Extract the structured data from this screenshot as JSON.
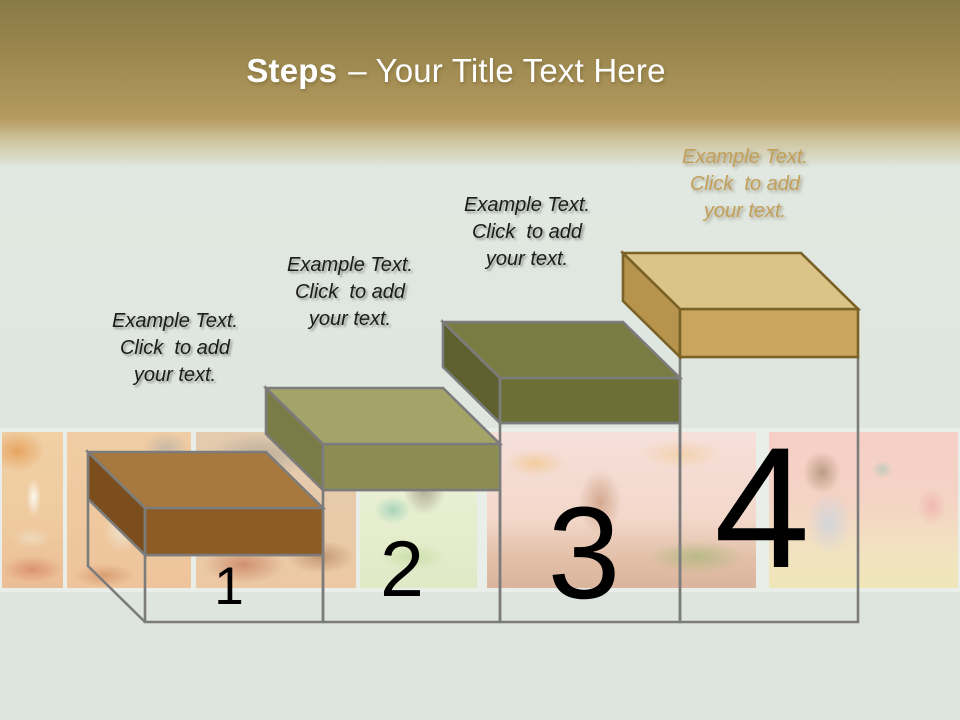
{
  "title": {
    "bold": "Steps",
    "rest": "– Your Title Text Here"
  },
  "steps": [
    {
      "number": "1",
      "label_lines": [
        "Example Text.",
        "Click  to add",
        "your text."
      ],
      "colors": {
        "top": "#A8793F",
        "front": "#8D5B24",
        "side": "#7C4E1D",
        "outline": "#7C7C7C"
      }
    },
    {
      "number": "2",
      "label_lines": [
        "Example Text.",
        "Click  to add",
        "your text."
      ],
      "colors": {
        "top": "#A4A469",
        "front": "#8D8D53",
        "side": "#7B7B47",
        "outline": "#7C7C7C"
      }
    },
    {
      "number": "3",
      "label_lines": [
        "Example Text.",
        "Click  to add",
        "your text."
      ],
      "colors": {
        "top": "#7A7C43",
        "front": "#6D7036",
        "side": "#5E602D",
        "outline": "#7C7C7C"
      }
    },
    {
      "number": "4",
      "label_lines": [
        "Example Text.",
        "Click  to add",
        "your text."
      ],
      "label_color": "#C2A05A",
      "colors": {
        "top": "#DCC489",
        "front": "#C9A55E",
        "side": "#B7944D",
        "outline": "#7A6226"
      }
    }
  ],
  "theme": {
    "header_gold_top": "#8A7A46",
    "header_gold": "#B49A5E",
    "body_background": "#DFE6DF",
    "wireframe": "#7C7C7C",
    "number_color": "#000000",
    "label_color": "#1C1C1C",
    "title_color": "#FFFFFF"
  },
  "photo_strip": {
    "panel_colors": [
      "#EFCBA2",
      "#EFC69E",
      "#E6C9A8",
      "#E9EFD3",
      "#F3D9CC",
      "#F4D2C4"
    ]
  }
}
